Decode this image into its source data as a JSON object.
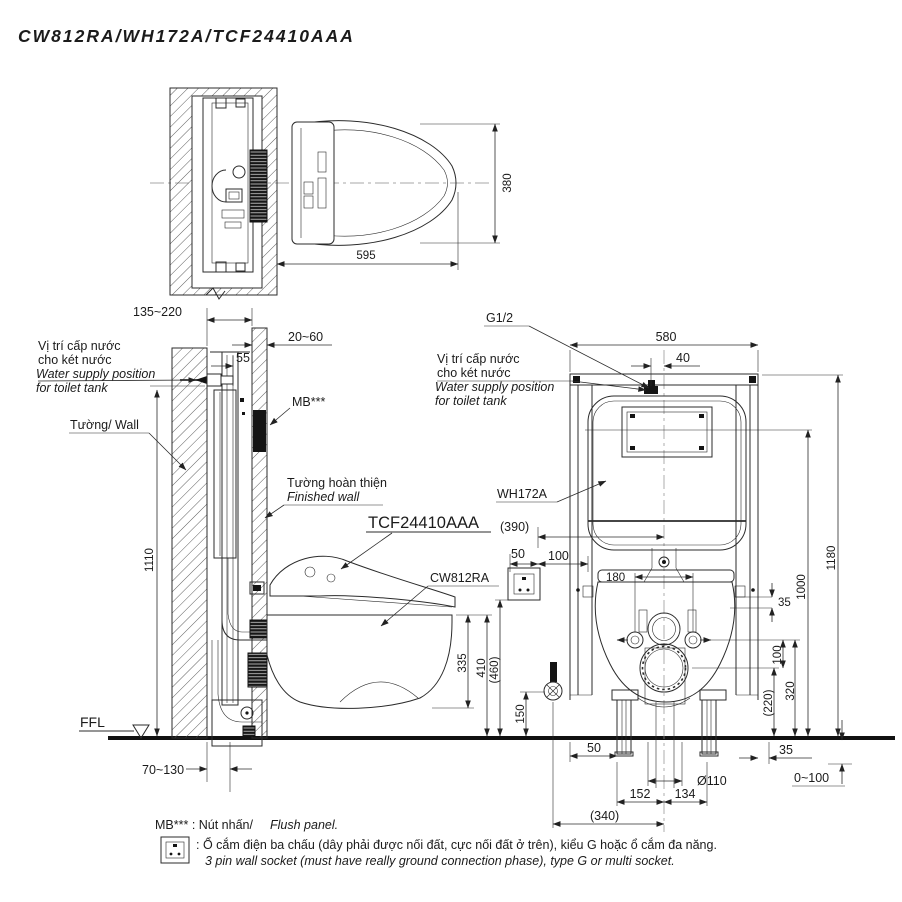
{
  "title": "CW812RA/WH172A/TCF24410AAA",
  "top": {
    "d380": "380",
    "d595": "595"
  },
  "side": {
    "ws1": "Vị trí cấp nước",
    "ws2": "cho két nước",
    "ws3": "Water supply position",
    "ws4": "for toilet tank",
    "wall": "Tường/ Wall",
    "fw1": "Tường hoàn thiện",
    "fw2": "Finished wall",
    "mb": "MB***",
    "tcf": "TCF24410AAA",
    "cw": "CW812RA",
    "ffl": "FFL",
    "d135": "135~220",
    "d20": "20~60",
    "d55": "55",
    "d1110": "1110",
    "d335": "335",
    "d410": "410",
    "d70": "70~130"
  },
  "front": {
    "g12": "G1/2",
    "ws1": "Vị trí cấp nước",
    "ws2": "cho két nước",
    "ws3": "Water supply position",
    "ws4": "for toilet tank",
    "wh": "WH172A",
    "d580": "580",
    "d40": "40",
    "d390": "(390)",
    "s50": "50",
    "s100": "100",
    "d180": "180",
    "r35": "35",
    "r100": "100",
    "r320": "320",
    "r220": "(220)",
    "r1000": "1000",
    "r1180": "1180",
    "l460": "(460)",
    "l150": "150",
    "b50": "50",
    "b35": "35",
    "dia": "Ø110",
    "rng": "0~100",
    "d152": "152",
    "d134": "134",
    "d340": "(340)"
  },
  "notes": {
    "mb_left": "MB*** : Nút nhấn/",
    "mb_right": "Flush panel.",
    "socket_vi": ": Ổ cắm điện ba chấu (dây phải được nối đất, cực nối đất ở trên), kiểu G hoặc ổ cắm đa năng.",
    "socket_en": "3 pin wall socket (must have really ground connection phase), type G or multi socket."
  }
}
